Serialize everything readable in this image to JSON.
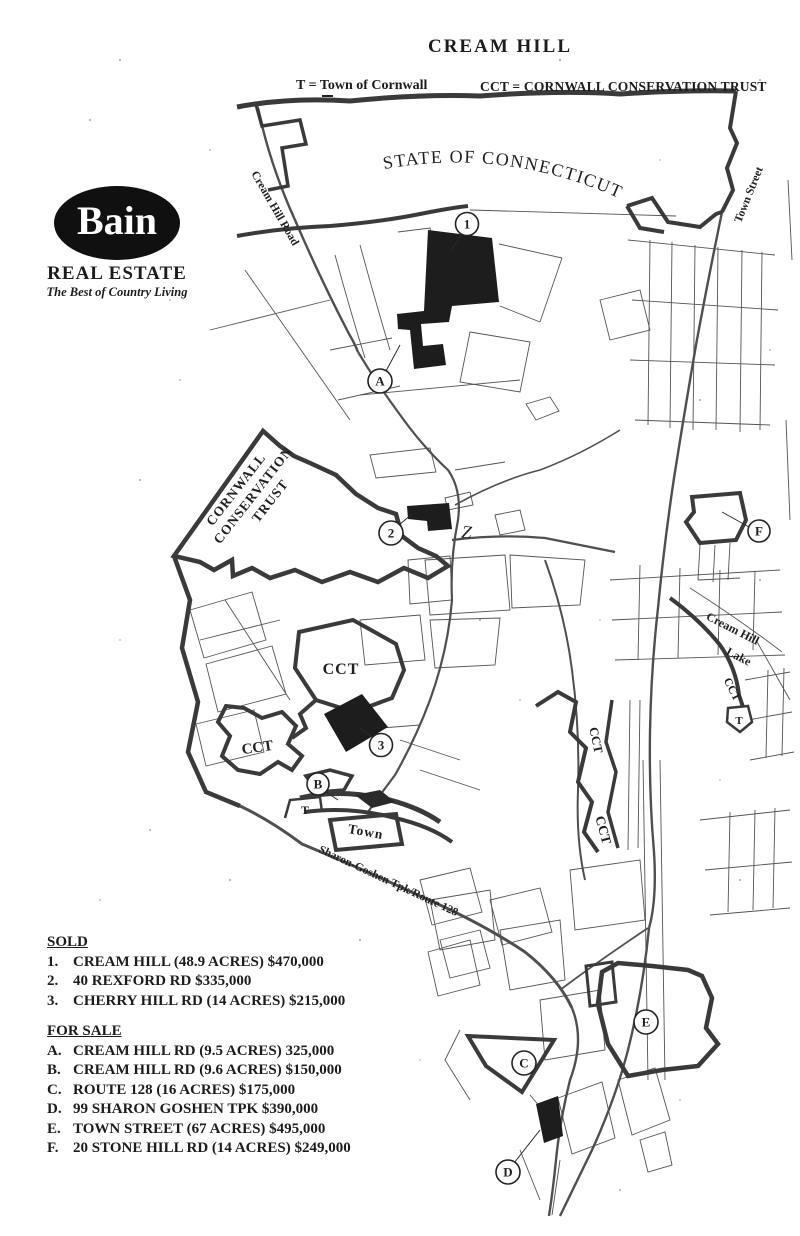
{
  "title": "CREAM HILL",
  "legend": {
    "t": "T = Town of Cornwall",
    "cct": "CCT = CORNWALL CONSERVATION TRUST"
  },
  "logo": {
    "name": "Bain",
    "tagline1": "REAL ESTATE",
    "tagline2": "The Best of Country Living"
  },
  "map": {
    "state_label": "STATE OF CONNECTICUT",
    "roads": {
      "cream_hill_road": "Cream Hill Road",
      "town_street": "Town Street",
      "sharon_goshen_tpk": "Sharon-Goshen Tpk/Route 128"
    },
    "areas": {
      "cct_full_1": "CORNWALL",
      "cct_full_2": "CONSERVATION",
      "cct_full_3": "TRUST",
      "cct": "CCT",
      "town": "Town",
      "lake_1": "Cream Hill",
      "lake_2": "Lake",
      "t": "T",
      "z": "Z"
    },
    "markers": {
      "1": "1",
      "2": "2",
      "3": "3",
      "A": "A",
      "B": "B",
      "C": "C",
      "D": "D",
      "E": "E",
      "F": "F"
    }
  },
  "sold": {
    "heading": "SOLD",
    "items": [
      {
        "num": "1.",
        "desc": "CREAM HILL (48.9 ACRES) $470,000"
      },
      {
        "num": "2.",
        "desc": "40 REXFORD RD $335,000"
      },
      {
        "num": "3.",
        "desc": "CHERRY HILL RD (14 ACRES) $215,000"
      }
    ]
  },
  "for_sale": {
    "heading": "FOR SALE",
    "items": [
      {
        "num": "A.",
        "desc": "CREAM HILL RD (9.5 ACRES) 325,000"
      },
      {
        "num": "B.",
        "desc": "CREAM HILL RD (9.6 ACRES) $150,000"
      },
      {
        "num": "C.",
        "desc": "ROUTE 128 (16 ACRES) $175,000"
      },
      {
        "num": "D.",
        "desc": "99 SHARON GOSHEN TPK $390,000"
      },
      {
        "num": "E.",
        "desc": "TOWN STREET (67 ACRES) $495,000"
      },
      {
        "num": "F.",
        "desc": "20 STONE HILL RD (14 ACRES) $249,000"
      }
    ]
  },
  "colors": {
    "ink": "#1c1c1c",
    "boundary": "#3a3a3a",
    "road": "#4f4f4f",
    "paper": "#ffffff"
  }
}
